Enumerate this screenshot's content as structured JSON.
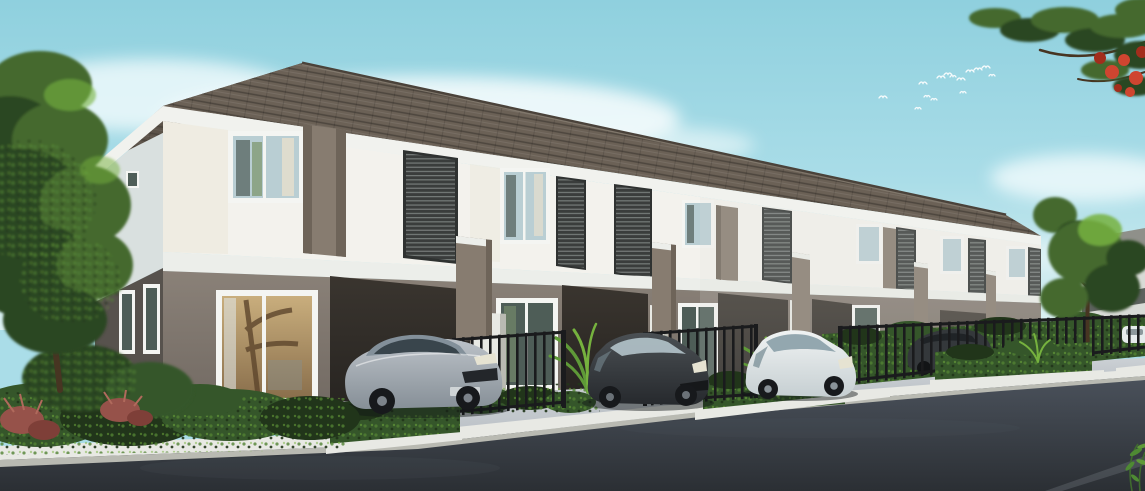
{
  "scene": {
    "type": "architectural_rendering",
    "setting": "Row of modern two-storey townhouses with brown tiled hip roof, white upper walls with dark louver screens and taupe accents, grey ground floor with carports, black metal fences, hedge planters with white curbs, cars parked on concrete driveways beside a dark asphalt road under a light blue sky",
    "time_of_day": "day",
    "visible_text": "none",
    "counts": {
      "townhouse_units": 6,
      "upper_windows": 6,
      "louver_panels": 7,
      "balcony_parapets": 5,
      "fence_segments": 3,
      "cars_foreground": 4,
      "cars_distant": 1,
      "palm_plants": 2,
      "bird_flock_size": 14
    },
    "objects": [
      {
        "name": "townhouse-row",
        "color_ref": "wall_upper"
      },
      {
        "name": "tiled-roof",
        "color_ref": "roof_front"
      },
      {
        "name": "silver-sedan",
        "color_ref": "car_silver"
      },
      {
        "name": "dark-hatchback",
        "color_ref": "car_dark_body"
      },
      {
        "name": "white-minivan",
        "color_ref": "car_white_body"
      },
      {
        "name": "dark-suv-behind-fence",
        "color_ref": "car_dark_shade"
      },
      {
        "name": "distant-white-car",
        "color_ref": "car_white_body"
      },
      {
        "name": "left-tree",
        "color_ref": "tree_dark"
      },
      {
        "name": "flame-tree-branch",
        "color_ref": "flower_red"
      },
      {
        "name": "bird-flock",
        "color_ref": "bird_white"
      },
      {
        "name": "asphalt-road",
        "color_ref": "road_bottom"
      },
      {
        "name": "hedge-planters",
        "color_ref": "hedge_mid"
      }
    ]
  },
  "birds": [
    [
      883,
      98,
      4
    ],
    [
      918,
      109,
      3
    ],
    [
      923,
      84,
      4
    ],
    [
      927,
      97,
      3
    ],
    [
      934,
      100,
      3
    ],
    [
      941,
      78,
      4
    ],
    [
      948,
      75,
      4
    ],
    [
      953,
      77,
      3
    ],
    [
      961,
      80,
      4
    ],
    [
      963,
      93,
      3
    ],
    [
      970,
      72,
      4
    ],
    [
      978,
      70,
      4
    ],
    [
      986,
      68,
      4
    ],
    [
      992,
      76,
      3
    ]
  ],
  "palette": {
    "sky_top": "#8fd0de",
    "sky_mid": "#aadde8",
    "sky_bottom": "#ddf1f2",
    "cloud": "#f3fbfc",
    "roof_front": "#6b6156",
    "roof_side": "#5c5349",
    "roof_edge": "#8a8174",
    "fascia": "#f1f2ee",
    "wall_upper": "#f3f2ed",
    "wall_upper_cream": "#ebe7d9",
    "wall_side": "#d9e0df",
    "wall_side_lower": "#57524d",
    "accent_taupe": "#877c70",
    "accent_taupe_dark": "#6e6459",
    "band_white": "#eceeea",
    "wall_lower": "#8a8178",
    "wall_lower_dark": "#6f6760",
    "carport": "#3a352f",
    "carport_deep": "#262320",
    "louver_dark": "#3a3d3c",
    "louver_light": "#979e9c",
    "louver_frame": "#2f3231",
    "window_frame": "#f4f5f2",
    "glass_cool": "#b9ced3",
    "glass_dark": "#4e5d57",
    "glass_warm": "#c9ae7d",
    "fence_dark": "#1a1b1d",
    "hedge_dark": "#21351a",
    "hedge_mid": "#35562a",
    "hedge_light": "#518233",
    "plant_bright": "#76b23e",
    "palm_green": "#5f9a38",
    "shrub_red": "#96524a",
    "flower_red": "#cf4530",
    "tree_dark": "#2c4724",
    "tree_light": "#44692f",
    "trunk_brown": "#473522",
    "distant_wall": "#d8dbd6",
    "distant_roof": "#8f908a",
    "road_top": "#4b525c",
    "road_bottom": "#2b2f34",
    "driveway": "#b6bcc2",
    "driveway_light": "#ccd1d5",
    "curb_white": "#e8e9e4",
    "curb_face": "#b9bab2",
    "car_silver": "#bcc2c8",
    "car_silver_shade": "#868f97",
    "car_dark_body": "#4b5054",
    "car_dark_shade": "#26292d",
    "car_white_body": "#f0f3f3",
    "car_white_shade": "#c6cfd2",
    "wheel_dark": "#17191c",
    "headlight": "#e6e3d2",
    "bird_white": "#f6fbfc"
  }
}
